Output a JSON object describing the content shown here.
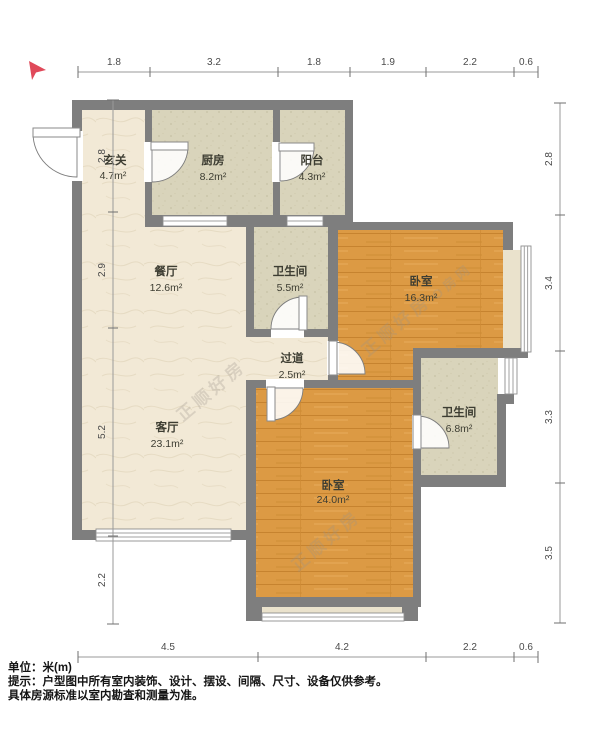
{
  "palette": {
    "wall": "#7e7e7e",
    "wood_floor": "#dc9a44",
    "tile_floor": "#d9d4bb",
    "cream_floor": "#f2e9d6",
    "bay_sill": "#eae2cc",
    "compass_red": "#e0495a",
    "dim_text": "#4a4a4a",
    "label_text": "#3d3d32"
  },
  "dimensions": {
    "top": [
      "1.8",
      "3.2",
      "1.8",
      "1.9",
      "2.2",
      "0.6"
    ],
    "bottom": [
      "4.5",
      "4.2",
      "2.2",
      "0.6"
    ],
    "left": [
      "2.8",
      "2.9",
      "5.2",
      "2.2"
    ],
    "right": [
      "2.8",
      "3.4",
      "3.3",
      "3.5"
    ]
  },
  "rooms": [
    {
      "name": "玄关",
      "area": "4.7m²"
    },
    {
      "name": "厨房",
      "area": "8.2m²"
    },
    {
      "name": "阳台",
      "area": "4.3m²"
    },
    {
      "name": "餐厅",
      "area": "12.6m²"
    },
    {
      "name": "卫生间",
      "area": "5.5m²"
    },
    {
      "name": "卧室",
      "area": "16.3m²"
    },
    {
      "name": "过道",
      "area": "2.5m²"
    },
    {
      "name": "卫生间",
      "area": "6.8m²"
    },
    {
      "name": "客厅",
      "area": "23.1m²"
    },
    {
      "name": "卧室",
      "area": "24.0m²"
    }
  ],
  "watermark": {
    "text": "正顺好房",
    "text2": "O房网"
  },
  "footer": {
    "line1": "单位：米(m)",
    "line2": "提示：户型图中所有室内装饰、设计、摆设、间隔、尺寸、设备仅供参考。",
    "line3": "具体房源标准以室内勘查和测量为准。"
  }
}
